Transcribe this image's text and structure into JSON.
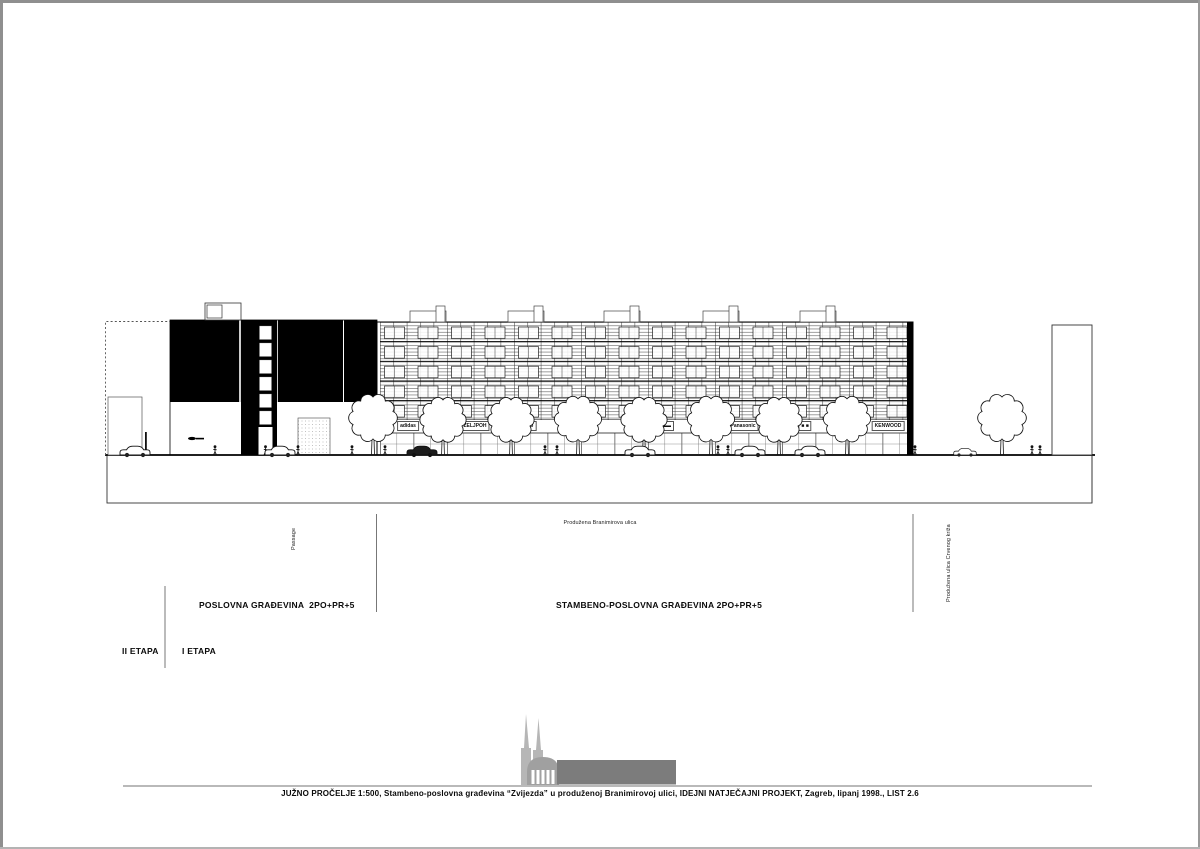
{
  "sheet": {
    "title": "JUŽNO PROČELJE",
    "scale": "1:500",
    "sheet_no": "LIST 2.6",
    "caption": "JUŽNO PROČELJE 1:500, Stambeno-poslovna građevina “Zvijezda” u produženoj Branimirovoj ulici, IDEJNI NATJEČAJNI PROJEKT, Zagreb, lipanj 1998., LIST 2.6"
  },
  "annotations": {
    "building_left": "POSLOVNA GRAĐEVINA  2PO+PR+5",
    "building_right": "STAMBENO-POSLOVNA GRAĐEVINA 2PO+PR+5",
    "phase_ii": "II ETAPA",
    "phase_i": "I ETAPA",
    "passage": "Passage",
    "street_center": "Produžena Branimirova ulica",
    "street_right": "Produžena ulica Crvenog križa"
  },
  "signs": [
    {
      "label": "adidas"
    },
    {
      "label": "ZELJPOH"
    },
    {
      "label": "daewoo"
    },
    {
      "label": "OTT"
    },
    {
      "label": "▬▬"
    },
    {
      "label": "Panasonic"
    },
    {
      "label": "■ ■"
    },
    {
      "label": "KENWOOD"
    }
  ],
  "colors": {
    "ink": "#000000",
    "paper": "#ffffff",
    "skyline_light": "#b6b6b6",
    "skyline_mid": "#a0a0a0",
    "skyline_dark": "#7c7c7c",
    "scan_edge": "#8f8f8f"
  }
}
